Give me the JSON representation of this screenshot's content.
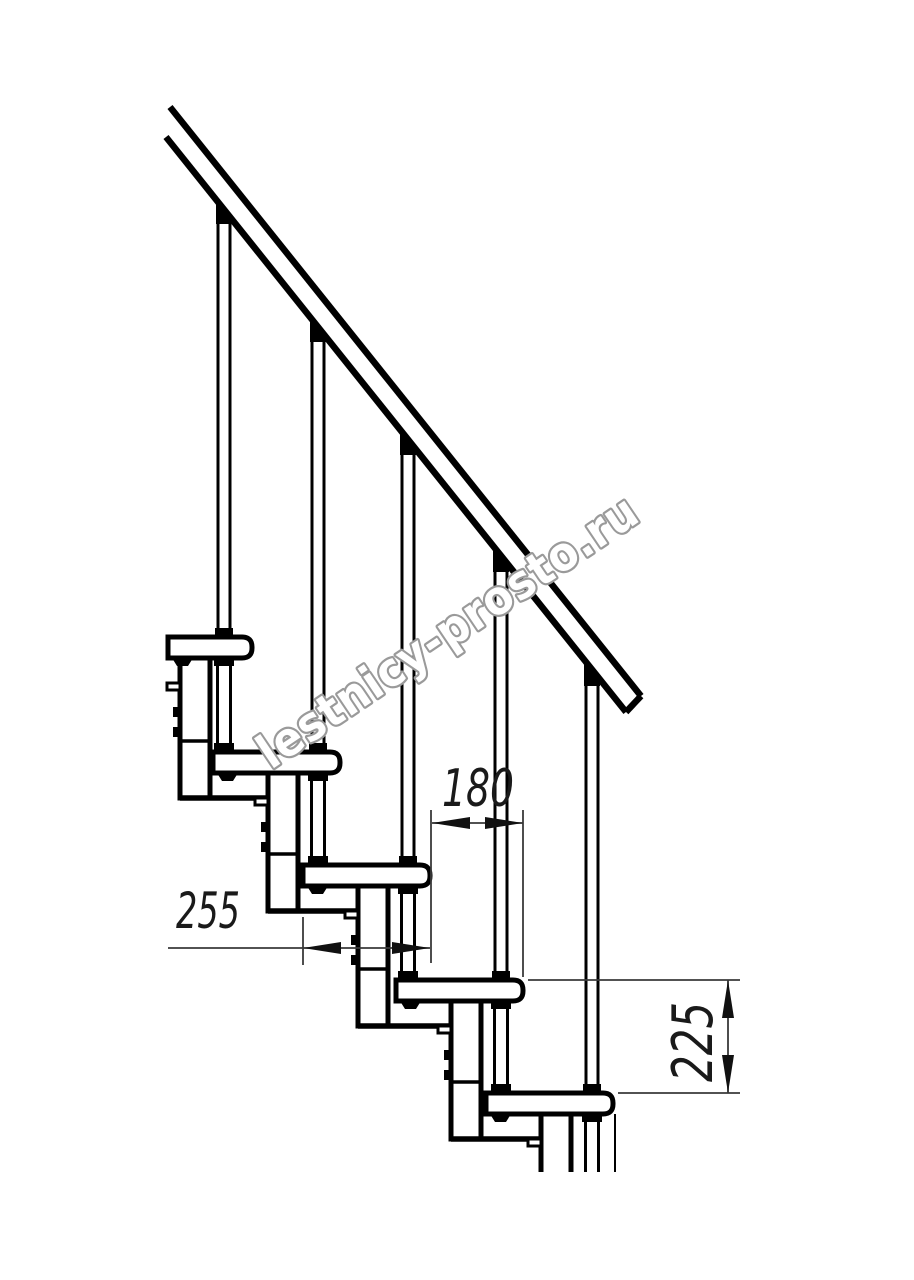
{
  "drawing": {
    "watermark": {
      "text": "lestnicy-prosto.ru",
      "color": "#9a9a9a"
    },
    "dimensions": {
      "tread_depth": {
        "value": "255"
      },
      "step_offset": {
        "value": "180"
      },
      "step_rise": {
        "value": "225"
      }
    },
    "colors": {
      "outline": "#000000",
      "dimension_lines": "#3a3a3a",
      "background": "#ffffff"
    }
  }
}
